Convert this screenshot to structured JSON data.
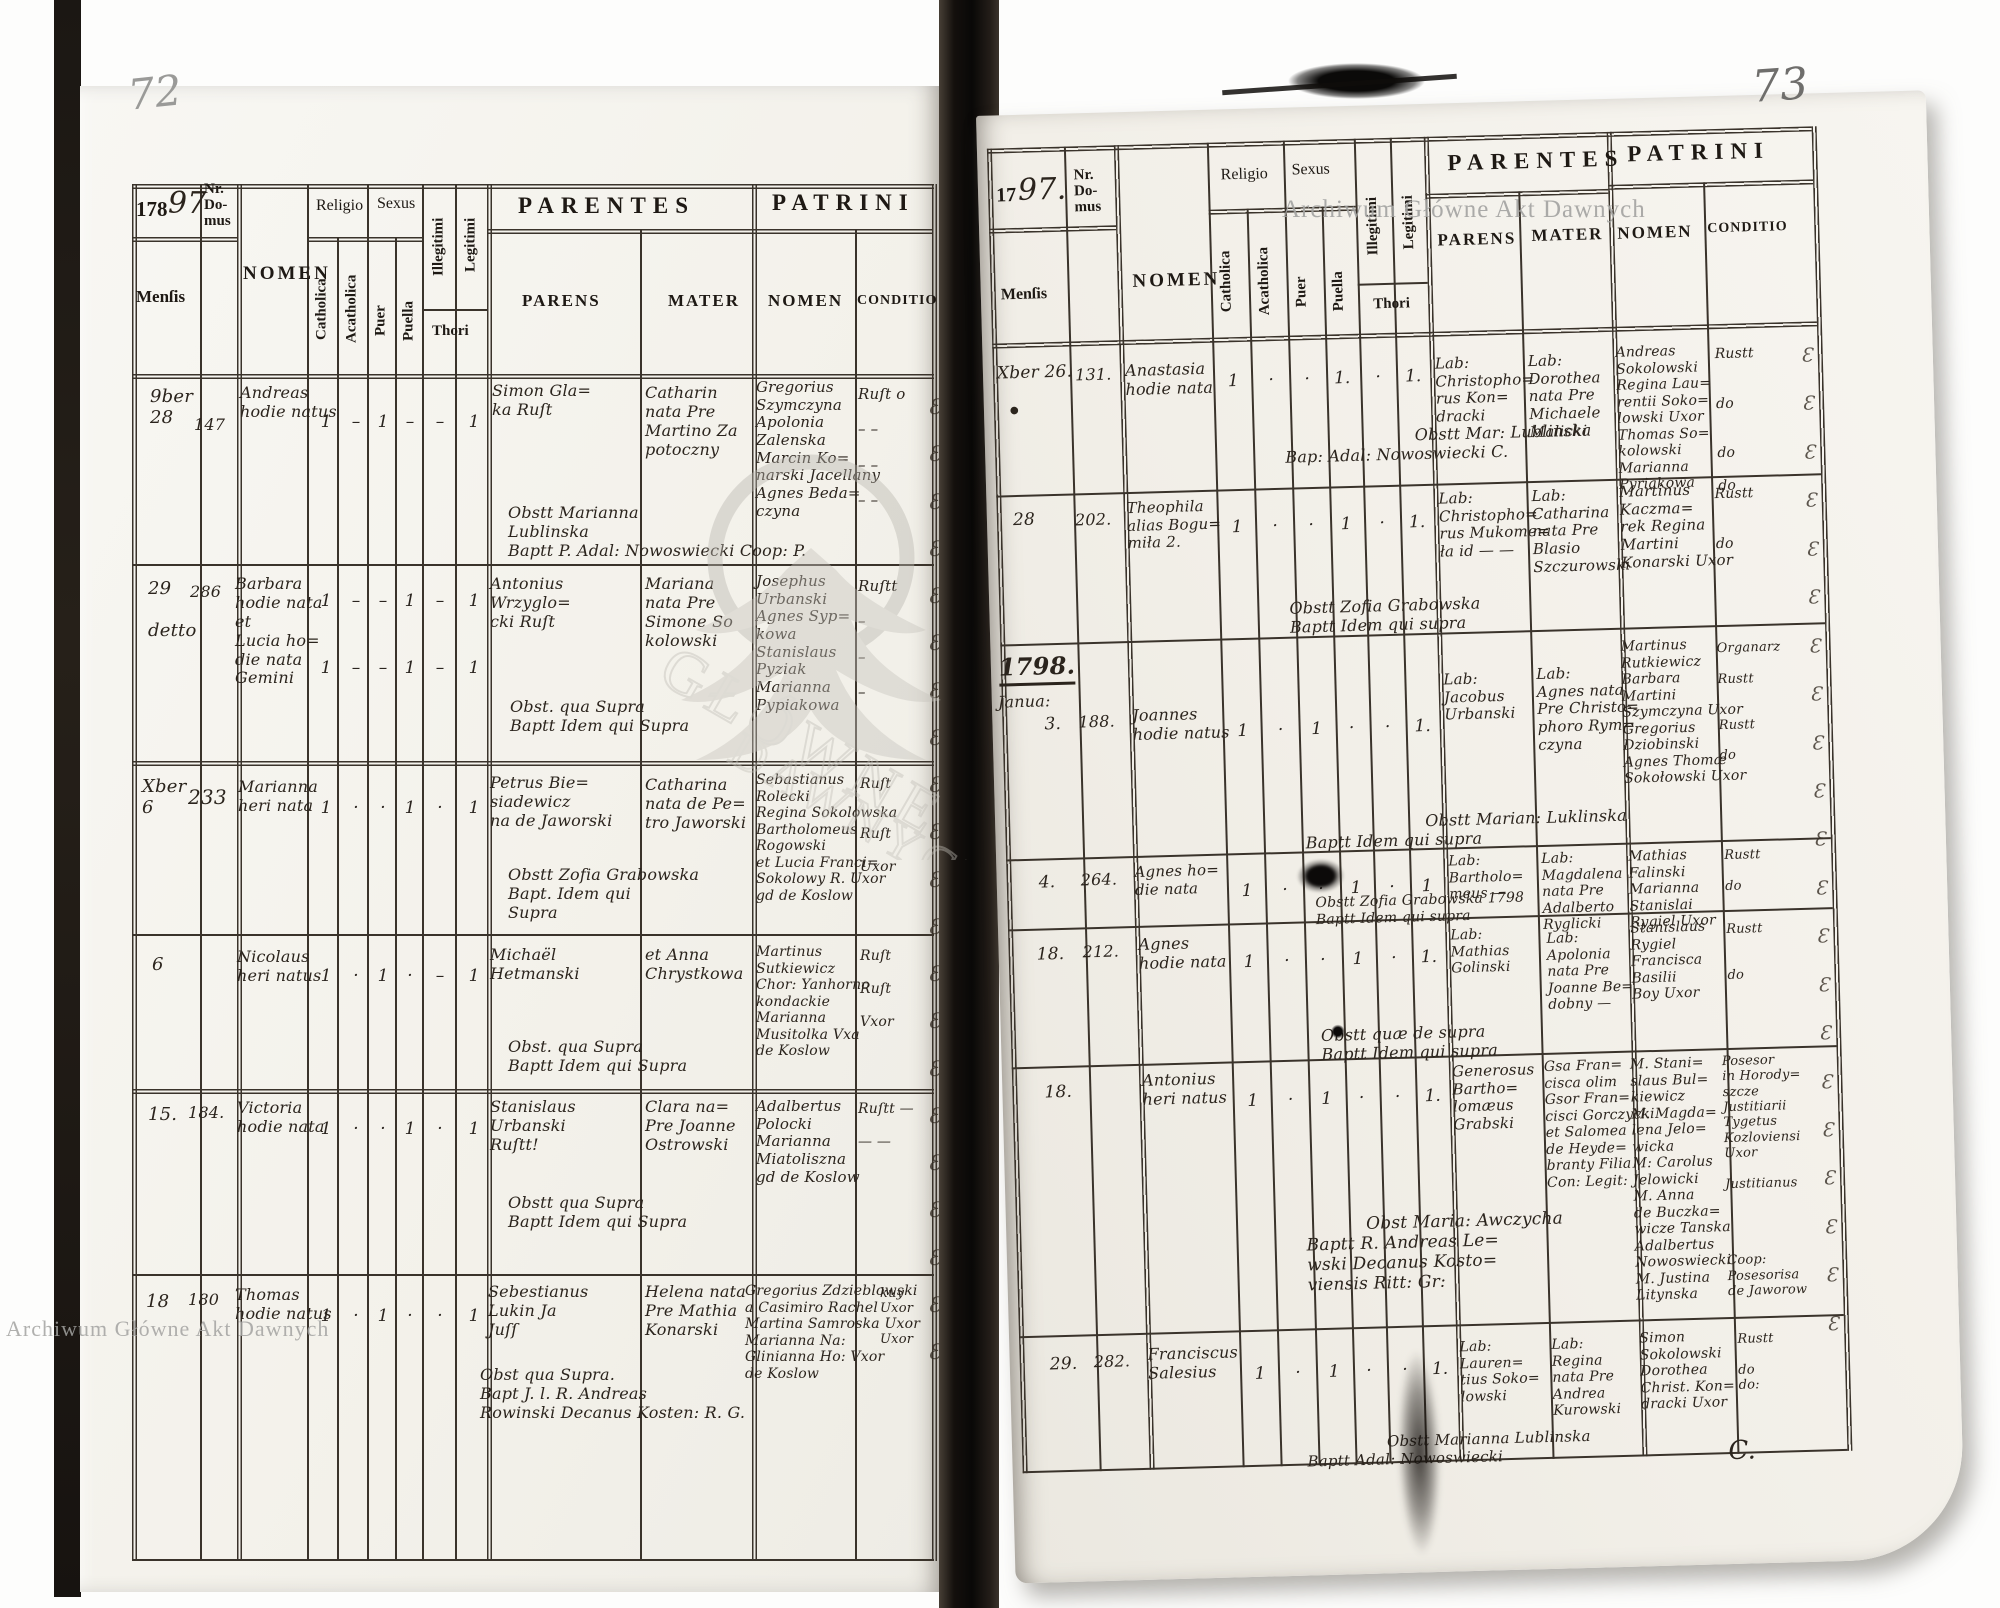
{
  "watermark": {
    "text": "Archiwum Główne Akt Dawnych",
    "seal1": "GŁÓWNE",
    "seal2": "DAWNYCH"
  },
  "marks": {
    "flourish_left": "Ɛ\nƐ\nƐ\nƐ\nƐ\nƐ\nƐ\nƐ\nƐ\nƐ\nƐ\nƐ\nƐ\nƐ\nƐ\nƐ\nƐ\nƐ\nƐ\nƐ\nƐ",
    "flourish_right": "Ɛ\nƐ\nƐ\nƐ\nƐ\nƐ\nƐ\nƐ\nƐ\nƐ\nƐ\nƐ\nƐ\nƐ\nƐ\nƐ\nƐ\nƐ\nƐ\nƐ\nƐ",
    "dot": "●"
  },
  "labels": {
    "nr_domus": "Nr.\nDo-\nmus",
    "nomen": "NOMEN",
    "religio": "Religio",
    "sexus": "Sexus",
    "catholica": "Catholica",
    "acatholica": "Acatholica",
    "puer": "Puer",
    "puella": "Puella",
    "illegitimi": "Illegitimi",
    "legitimi": "Legitimi",
    "thori": "Thori",
    "parentes": "PARENTES",
    "patrini": "PATRINI",
    "parens": "PARENS",
    "mater": "MATER",
    "conditio": "CONDITIO",
    "mensis": "Menſis"
  },
  "left": {
    "page_number": "72",
    "year_printed": "178",
    "year_hand": "97",
    "rows": [
      {
        "mensis": "9ber\n28",
        "nr": "147",
        "nomen": "Andreas\nhodie natus",
        "m": {
          "c": "1",
          "a": "–",
          "p": "1",
          "pl": "–",
          "i": "–",
          "l": "1"
        },
        "parens": "Simon Gla=\nka Ruſt",
        "mater": "Catharin\nnata Pre\nMartino Za\npotoczny",
        "patrini": "Gregorius\nSzymczyna\nApolonia\nZalenska\nMarcin Ko=\nnarski Jacellany\nAgnes Beda=\nczyna",
        "conditio": "Ruſt o\n\n–  –\n\n–  –\n\n–  –",
        "note": "Obstt Marianna\nLublinska\nBaptt P. Adal: Nowoswiecki Coop: P."
      },
      {
        "mensis": "29\n\ndetto",
        "nr": "286",
        "nomen": "Barbara\nhodie nata\net\nLucia ho=\ndie nata\nGemini",
        "m": {
          "c": "1",
          "a": "–",
          "p": "–",
          "pl": "1",
          "i": "–",
          "l": "1"
        },
        "m2": {
          "c": "1",
          "a": "–",
          "p": "–",
          "pl": "1",
          "i": "–",
          "l": "1"
        },
        "parens": "Antonius\nWrzyglo=\ncki Ruſt",
        "mater": "Mariana\nnata Pre\nSimone So\nkolowski",
        "patrini": "Josephus\nUrbanski\nAgnes Syp=\nkowa\nStanislaus\nPyziak\nMarianna\nPypiakowa",
        "conditio": "Ruſtt\n\n–\n\n–\n\n–",
        "note": "Obst. qua Supra\nBaptt Idem qui Supra"
      },
      {
        "mensis": "Xber\n6",
        "nr": "233",
        "nomen": "Marianna\nheri nata",
        "m": {
          "c": "1",
          "a": "·",
          "p": "·",
          "pl": "1",
          "i": "·",
          "l": "1"
        },
        "parens": "Petrus Bie=\nsiadewicz\nna de Jaworski",
        "mater": "Catharina\nnata de Pe=\ntro Jaworski",
        "patrini": "Sebastianus\nRolecki\nRegina Sokolowska\nBartholomeus\nRogowski\net Lucia Franci=\nSokolowy R. Uxor\ngd de Koslow",
        "conditio": "Ruſt\n\n\nRuſt\n\nUxor",
        "note": "Obstt Zofia Grabowska\nBapt. Idem qui\nSupra"
      },
      {
        "mensis": "6",
        "nomen": "Nicolaus\nheri natus",
        "m": {
          "c": "1",
          "a": "·",
          "p": "1",
          "pl": "·",
          "i": "–",
          "l": "1"
        },
        "parens": "Michaël\nHetmanski",
        "mater": "et Anna\nChrystkowa",
        "patrini": "Martinus\nSutkiewicz\nChor: Yanhorno\nkondackie\nMarianna\nMusitolka Vxa\nde Koslow",
        "conditio": "Ruſt\n\nRuſt\n\nVxor",
        "note": "Obst. qua Supra\nBaptt Idem qui Supra"
      },
      {
        "mensis": "15.",
        "nr": "184.",
        "nomen": "Victoria\nhodie nata",
        "m": {
          "c": "1",
          "a": "·",
          "p": "·",
          "pl": "1",
          "i": "·",
          "l": "1"
        },
        "parens": "Stanislaus\nUrbanski\nRuſtt!",
        "mater": "Clara na=\nPre Joanne\nOstrowski",
        "patrini": "Adalbertus\nPolocki\nMarianna\nMiatoliszna\ngd de Koslow",
        "conditio": "Ruſtt —\n\n— —",
        "note": "Obstt qua Supra\nBaptt Idem qui Supra"
      },
      {
        "mensis": "18",
        "nr": "180",
        "nomen": "Thomas\nhodie natus",
        "m": {
          "c": "1",
          "a": "·",
          "p": "1",
          "pl": "·",
          "i": "·",
          "l": "1"
        },
        "parens": "Sebestianus\nLukin Ja\nJuſſ",
        "mater": "Helena nata\nPre Mathia\nKonarski",
        "patrini": "Gregorius Zdzieblowski\na Casimiro Rachel\nMartina Samroska Uxor\nMarianna Na:\nGlinianna Ho: Vxor\nde Koslow",
        "conditio": "kuy\nUxor\n\nUxor",
        "note": "Obst qua Supra.\nBapt J. l. R. Andreas\nRowinski Decanus Kosten: R. G."
      }
    ]
  },
  "right": {
    "page_number": "73",
    "year_printed": "17",
    "year_hand": "97.",
    "year_break": {
      "year": "1798.",
      "month": "Janua:"
    },
    "rows": [
      {
        "mensis": "Xber 26.",
        "nr": "131.",
        "nomen": "Anastasia\nhodie nata",
        "m": {
          "c": "1",
          "a": "·",
          "p": "·",
          "pl": "1.",
          "i": "·",
          "l": "1."
        },
        "parens": "Lab:\nChristopho=\nrus Kon=\ndracki",
        "mater": "Lab:\nDorothea\nnata Pre\nMichaele\nMalicki",
        "patrini": "Andreas\nSokolowski\nRegina Lau=\nrentii Soko=\nlowski Uxor\nThomas So=\nkolowski\nMarianna\nPyriakowa",
        "conditio": "Rustt\n\n\ndo\n\n\ndo\n\ndo",
        "note": "Obstt Mar: Lublinska\nBap: Adal: Nowoswiecki C."
      },
      {
        "mensis": "28",
        "nr": "202.",
        "nomen": "Theophila\nalias Bogu=\nmiła 2.",
        "m": {
          "c": "1",
          "a": "·",
          "p": "·",
          "pl": "1",
          "i": "·",
          "l": "1."
        },
        "parens": "Lab:\nChristopho=\nrus Mukome=\nła id — —",
        "mater": "Lab:\nCatharina\nnata Pre\nBlasio\nSzczurowski",
        "patrini": "Martinus\nKaczma=\nrek Regina\nMartini\nKonarski Uxor",
        "conditio": "Rustt\n\n\ndo",
        "note": "Obstt Zofia Grabowska\nBaptt Idem qui supra"
      },
      {
        "mensis": "3.",
        "nr": "188.",
        "nomen": "Joannes\nhodie natus",
        "m": {
          "c": "1",
          "a": "·",
          "p": "1",
          "pl": "·",
          "i": "·",
          "l": "1."
        },
        "parens": "Lab:\nJacobus\nUrbanski",
        "mater": "Lab:\nAgnes nata\nPre Christo=\nphoro Rym=\nczyna",
        "patrini": "Martinus\nRutkiewicz\nBarbara\nMartini\nSzymczyna Uxor\nGregorius\nDziobinski\nAgnes Thomæ\nSokołowski Uxor",
        "conditio": "Organarz\n\nRustt\n\n\nRustt\n\ndo",
        "note": "Obstt Marian: Luklinska\nBaptt Idem qui supra"
      },
      {
        "mensis": "4.",
        "nr": "264.",
        "nomen": "Agnes ho=\ndie nata",
        "m": {
          "c": "1",
          "a": "·",
          "p": "·",
          "pl": "1",
          "i": "·",
          "l": "1"
        },
        "parens": "Lab:\nBartholo=\nmeus —",
        "mater": "Lab:\nMagdalena\nnata Pre\nAdalberto\nRyglicki",
        "patrini": "Mathias\nFalinski\nMarianna\nStanislai\nRygiel Uxor",
        "conditio": "Rustt\n\ndo",
        "note": "Obstt Zofia Grabowska 1798\nBaptt Idem qui supra"
      },
      {
        "mensis": "18.",
        "nr": "212.",
        "nomen": "Agnes\nhodie nata",
        "m": {
          "c": "1",
          "a": "·",
          "p": "·",
          "pl": "1",
          "i": "·",
          "l": "1."
        },
        "parens": "Lab:\nMathias\nGolinski",
        "mater": "Lab:\nApolonia\nnata Pre\nJoanne Be=\ndobny —",
        "patrini": "Stanislaus\nRygiel\nFrancisca\nBasilii\nBoy Uxor",
        "conditio": "Rustt\n\n\ndo",
        "note": "Obstt quæ de supra\nBaptt Idem qui supra"
      },
      {
        "mensis": "18.",
        "nomen": "Antonius\nheri natus",
        "m": {
          "c": "1",
          "a": "·",
          "p": "1",
          "pl": "·",
          "i": "·",
          "l": "1."
        },
        "parens": "Generosus\nBartho=\nlomæus\nGrabski",
        "mater": "Gsa Fran=\ncisca olim\nGsor Fran=\ncisci Gorczycki\net Salomea\nde Heyde=\nbranty Filia\nCon: Legit:",
        "patrini": "M. Stani=\nslaus Bul=\nkiewicz\nM. Magda=\nlena Jelo=\nwicka\nM: Carolus\nJelowicki\nM. Anna\nde Buczka=\nwicze Tanska\nAdalbertus\nNowoswiecki\nM. Justina\nLitynska",
        "conditio": "Posesor\nin Horody=\nszcze\nJustitiarii\nTygetus\nKozloviensi\nUxor\n\nJustitianus\n\n\n\n\nCoop:\nPosesorisa\nde Jaworow",
        "note": "Obst Maria: Awczycha\nBaptt R. Andreas Le=\nwski Decanus Kosto=\nviensis Ritt: Gr:"
      },
      {
        "mensis": "29.",
        "nr": "282.",
        "nomen": "Franciscus\nSalesius",
        "m": {
          "c": "1",
          "a": "·",
          "p": "1",
          "pl": "·",
          "i": "·",
          "l": "1."
        },
        "parens": "Lab:\nLauren=\ntius Soko=\nlowski",
        "mater": "Lab:\nRegina\nnata Pre\nAndrea\nKurowski",
        "patrini": "Simon\nSokolowski\nDorothea\nChrist. Kon=\ndracki Uxor",
        "conditio": "Rustt\n\ndo\ndo:",
        "note": "Obstt Marianna Lublinska\nBaptt Adal: Nowoswiecki",
        "seal": "C."
      }
    ]
  }
}
